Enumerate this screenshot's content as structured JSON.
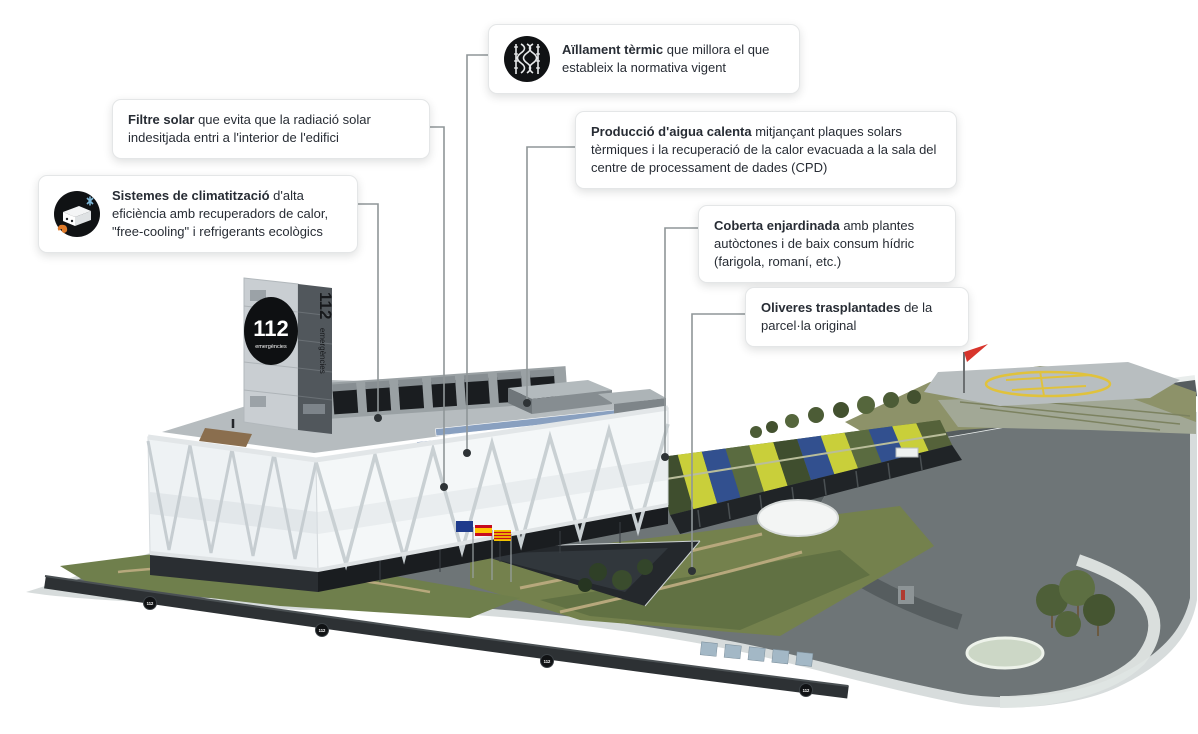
{
  "callouts": [
    {
      "id": "aillament",
      "bold": "Aïllament tèrmic",
      "rest": " que millora el que estableix la normativa vigent",
      "icon": "insulation-icon"
    },
    {
      "id": "filtre",
      "bold": "Filtre solar",
      "rest": " que evita que la radiació solar indesitjada entri a l'interior de l'edifici"
    },
    {
      "id": "produccio",
      "bold": "Producció d'aigua calenta",
      "rest": " mitjançant plaques solars tèrmiques i la recuperació de la calor evacuada a la sala del centre de processament de dades (CPD)"
    },
    {
      "id": "sistemes",
      "bold": "Sistemes de climatització",
      "rest": " d'alta eficiència amb recuperadors de calor, \"free-cooling\" i refrigerants ecològics",
      "icon": "climate-unit-icon"
    },
    {
      "id": "coberta",
      "bold": "Coberta enjardinada",
      "rest": " amb plantes autòctones i de baix consum hídric (farigola, romaní, etc.)"
    },
    {
      "id": "oliveres",
      "bold": "Oliveres trasplantades",
      "rest": " de la parcel·la original"
    }
  ],
  "building": {
    "tower_logo_number": "112",
    "tower_logo_caption": "emergències",
    "tower_side_number": "112",
    "tower_side_caption": "emergències",
    "wall_badge": "112"
  },
  "icons": {
    "aillament": "insulation-icon",
    "sistemes": "climate-unit-icon"
  },
  "colors": {
    "callout_bg": "#ffffff",
    "callout_border": "#e4e6e7",
    "text": "#272c34",
    "leader_line": "#8f9698",
    "icon_bg": "#101214",
    "vegetation_green": "#74814d",
    "stripe_yellow": "#c9cf3a",
    "stripe_blue": "#32508f",
    "windsock_red": "#d8352c"
  }
}
